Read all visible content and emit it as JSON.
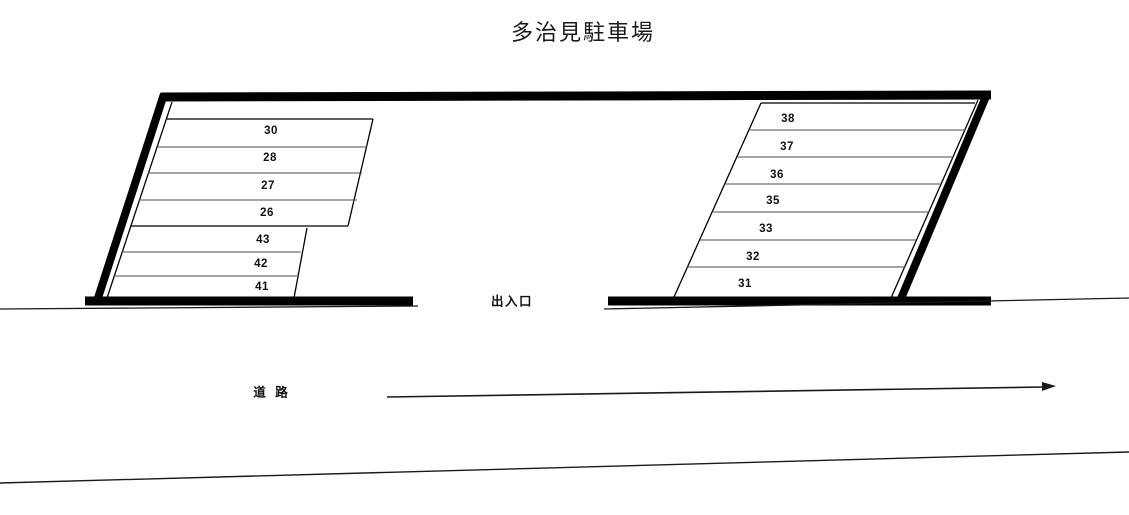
{
  "title": "多治見駐車場",
  "labels": {
    "entrance_exit": "出入口",
    "road": "道 路"
  },
  "parking": {
    "left_block": {
      "stalls": [
        "30",
        "28",
        "27",
        "26",
        "43",
        "42",
        "41"
      ]
    },
    "right_block": {
      "stalls": [
        "38",
        "37",
        "36",
        "35",
        "33",
        "32",
        "31"
      ]
    }
  },
  "road": {
    "direction_arrow": "right"
  },
  "colors": {
    "line": "#000000",
    "divider": "#4d4d4d",
    "background": "#ffffff"
  }
}
